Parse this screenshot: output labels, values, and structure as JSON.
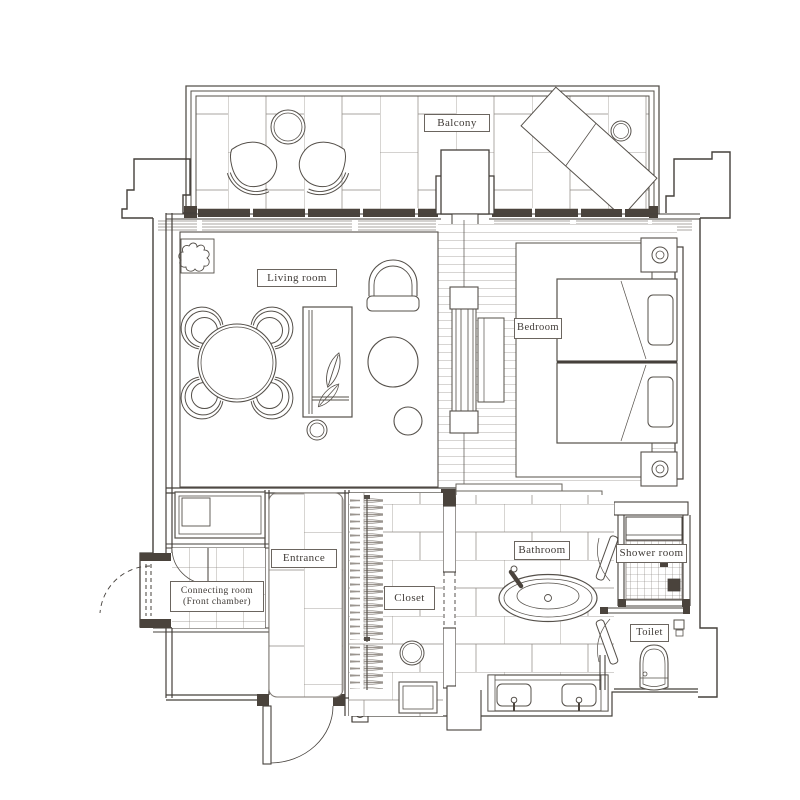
{
  "rooms": {
    "balcony": {
      "label": "Balcony"
    },
    "living_room": {
      "label": "Living room"
    },
    "bedroom": {
      "label": "Bedroom"
    },
    "entrance": {
      "label": "Entrance"
    },
    "connecting_room": {
      "label_line1": "Connecting room",
      "label_line2": "(Front chamber)"
    },
    "closet": {
      "label": "Closet"
    },
    "bathroom": {
      "label": "Bathroom"
    },
    "shower_room": {
      "label": "Shower room"
    },
    "toilet": {
      "label": "Toilet"
    }
  },
  "fixtures": [
    "balcony-round-table",
    "balcony-chairs",
    "balcony-lounge-chair",
    "balcony-side-table",
    "living-plant",
    "dining-table-with-chairs",
    "sofa-with-plant",
    "armchair",
    "round-lounge-chair",
    "stool",
    "tv-partition",
    "bedside-cabinet",
    "twin-bed",
    "nightstand-with-lamp",
    "luggage-cabinet",
    "wardrobe-hangers",
    "closet-stool",
    "closet-ottoman",
    "freestanding-bathtub",
    "double-vanity-sinks",
    "shower-bench",
    "toilet-bowl",
    "door-swings"
  ],
  "colors": {
    "paper": "#ffffff",
    "ink": "#55504a",
    "wall_dark": "#4a433c",
    "tile_line": "#8d8781"
  }
}
